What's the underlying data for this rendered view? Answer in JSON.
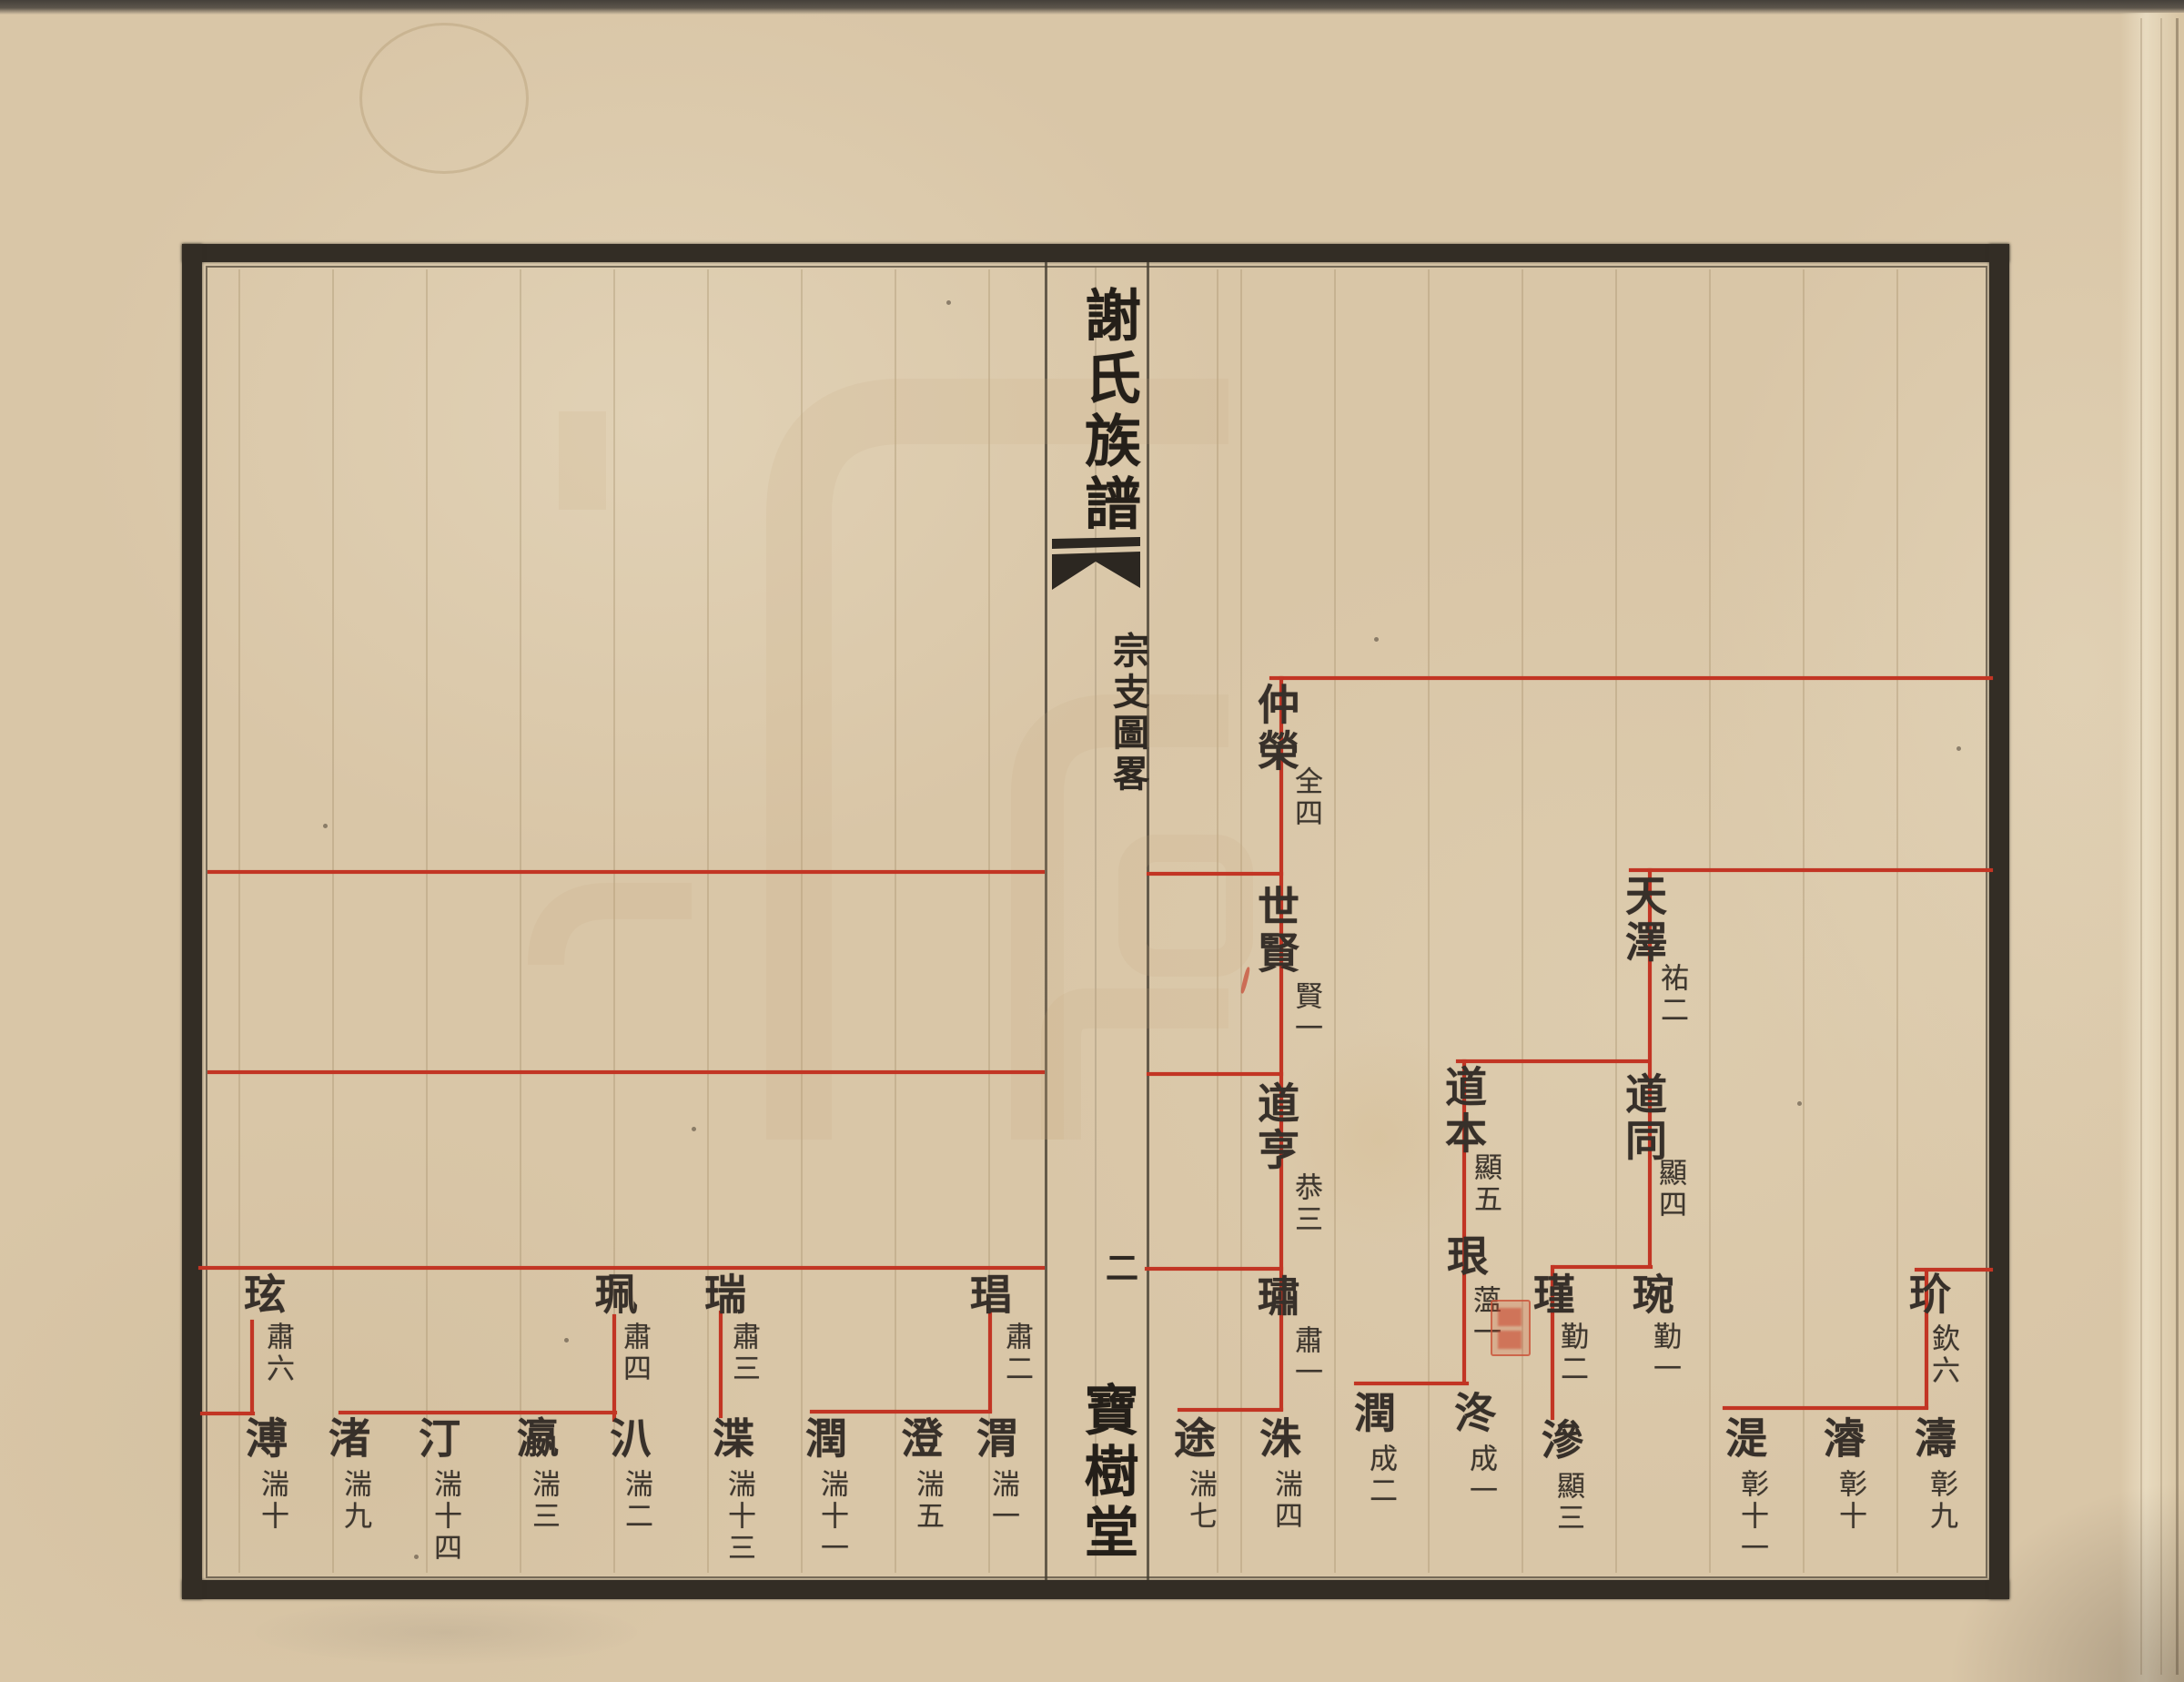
{
  "fold": {
    "spread_title": "謝氏族譜",
    "section_title": "宗支圖畧",
    "page_number": "二",
    "hall_name": "寶樹堂"
  },
  "colors": {
    "paper": "#d9c6a7",
    "frame_ink": "#332d25",
    "text_ink": "#37302a",
    "chart_line_red": "#c23524",
    "seal_red": "#c94f35",
    "watermark_tan": "#c3a77d"
  },
  "icons": {
    "fishtail_ornament": "black fishtail (魚尾) printing mark in folding column",
    "collector_seal": "small illegible red seal stamp beside 珢",
    "watermark": "large faint maze-like seal-script pattern on paper"
  },
  "genealogy": {
    "type": "descent-chart, vertical Chinese text, red hand-ruled connecting lines",
    "people": [
      {
        "id": "zhongrong",
        "name": "仲榮",
        "rank": "全四",
        "parent": null,
        "note": "sibling line runs to right page edge"
      },
      {
        "id": "shixian",
        "name": "世賢",
        "rank": "賢一",
        "parent": "zhongrong",
        "note": "sibling line runs to left page edge"
      },
      {
        "id": "daoheng",
        "name": "道亨",
        "rank": "恭三",
        "parent": "shixian",
        "note": "sibling line runs to left page edge"
      },
      {
        "id": "su",
        "name": "璛",
        "rank": "肅一",
        "parent": "daoheng"
      },
      {
        "id": "zhu",
        "name": "洙",
        "rank": "湍四",
        "parent": "su"
      },
      {
        "id": "tu",
        "name": "途",
        "rank": "湍七",
        "parent": "su"
      },
      {
        "id": "chang",
        "name": "琩",
        "rank": "肅二",
        "parent": "daoheng"
      },
      {
        "id": "wei",
        "name": "渭",
        "rank": "湍一",
        "parent": "chang"
      },
      {
        "id": "cheng",
        "name": "澄",
        "rank": "湍五",
        "parent": "chang"
      },
      {
        "id": "run2",
        "name": "潤",
        "rank": "湍十一",
        "parent": "chang"
      },
      {
        "id": "rui",
        "name": "瑞",
        "rank": "肅三",
        "parent": "daoheng"
      },
      {
        "id": "xie2",
        "name": "渫",
        "rank": "湍十三",
        "parent": "rui"
      },
      {
        "id": "pei",
        "name": "珮",
        "rank": "肅四",
        "parent": "daoheng"
      },
      {
        "id": "pa",
        "name": "汃",
        "rank": "湍二",
        "parent": "pei"
      },
      {
        "id": "ying",
        "name": "瀛",
        "rank": "湍三",
        "parent": "pei"
      },
      {
        "id": "ting",
        "name": "汀",
        "rank": "湍十四",
        "parent": "pei"
      },
      {
        "id": "zhu2",
        "name": "渚",
        "rank": "湍九",
        "parent": "pei"
      },
      {
        "id": "xuan",
        "name": "玹",
        "rank": "肅六",
        "parent": "daoheng"
      },
      {
        "id": "pu",
        "name": "溥",
        "rank": "湍十",
        "parent": "xuan"
      },
      {
        "id": "tianze",
        "name": "天澤",
        "rank": "祐二",
        "parent": null,
        "note": "line enters from right page edge"
      },
      {
        "id": "daotong",
        "name": "道同",
        "rank": "顯四",
        "parent": "tianze"
      },
      {
        "id": "daoben",
        "name": "道本",
        "rank": "顯五",
        "parent": "tianze"
      },
      {
        "id": "wan",
        "name": "琬",
        "rank": "勤一",
        "parent": "daotong"
      },
      {
        "id": "jin",
        "name": "瑾",
        "rank": "勤二",
        "parent": "daotong"
      },
      {
        "id": "shen",
        "name": "滲",
        "rank": "顯三",
        "parent": "jin"
      },
      {
        "id": "gen",
        "name": "珢",
        "rank": "薀一",
        "parent": "daoben",
        "seal": true
      },
      {
        "id": "zhong2",
        "name": "泈",
        "rank": "成一",
        "parent": "gen"
      },
      {
        "id": "run3",
        "name": "潤",
        "rank": "成二",
        "parent": "gen"
      },
      {
        "id": "jie",
        "name": "玠",
        "rank": "欽六",
        "parent": null,
        "note": "line enters from right page edge"
      },
      {
        "id": "tao",
        "name": "濤",
        "rank": "彰九",
        "parent": "jie"
      },
      {
        "id": "jun",
        "name": "濬",
        "rank": "彰十",
        "parent": "jie"
      },
      {
        "id": "shi",
        "name": "湜",
        "rank": "彰十一",
        "parent": "jie"
      }
    ]
  }
}
